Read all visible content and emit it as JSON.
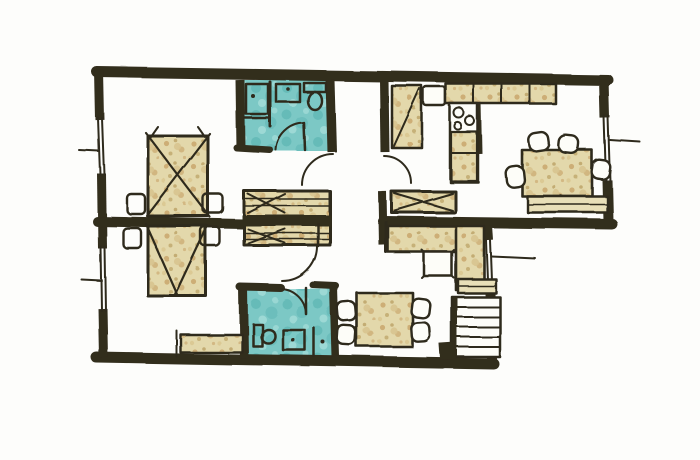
{
  "diagram": {
    "kind": "hand-drawn watercolor apartment floor plan",
    "text_content": "",
    "rooms": [
      {
        "name": "bedroom-top-left"
      },
      {
        "name": "bedroom-bottom-left"
      },
      {
        "name": "bathroom-top"
      },
      {
        "name": "bathroom-bottom"
      },
      {
        "name": "hallway-center"
      },
      {
        "name": "kitchen"
      },
      {
        "name": "dining-room-right"
      },
      {
        "name": "living-area-bottom"
      },
      {
        "name": "stair-landing"
      }
    ],
    "furniture": [
      {
        "name": "double-bed-top",
        "room": "bedroom-top-left"
      },
      {
        "name": "nightstand",
        "count": 2,
        "room": "bedroom-top-left"
      },
      {
        "name": "double-bed-bottom",
        "room": "bedroom-bottom-left"
      },
      {
        "name": "nightstand",
        "count": 2,
        "room": "bedroom-bottom-left"
      },
      {
        "name": "bench-dresser",
        "room": "bedroom-bottom-left"
      },
      {
        "name": "shower",
        "room": "bathroom-top"
      },
      {
        "name": "sink",
        "room": "bathroom-top"
      },
      {
        "name": "toilet",
        "room": "bathroom-top"
      },
      {
        "name": "toilet",
        "room": "bathroom-bottom"
      },
      {
        "name": "sink",
        "room": "bathroom-bottom"
      },
      {
        "name": "shower-corner",
        "room": "bathroom-bottom"
      },
      {
        "name": "double-wardrobe-with-x-marks",
        "room": "hallway-center"
      },
      {
        "name": "hall-wardrobe-with-x-marks",
        "room": "hallway-center"
      },
      {
        "name": "pantry-cabinet-with-diagonal-door",
        "room": "kitchen"
      },
      {
        "name": "fridge",
        "room": "kitchen"
      },
      {
        "name": "counter-run",
        "room": "kitchen"
      },
      {
        "name": "sink-stove-corner-unit",
        "room": "kitchen"
      },
      {
        "name": "dining-table",
        "chairs": 4,
        "room": "dining-room-right"
      },
      {
        "name": "sideboard-band",
        "room": "dining-room-right"
      },
      {
        "name": "l-shaped-sofa",
        "room": "living-area-bottom"
      },
      {
        "name": "coffee-table",
        "room": "living-area-bottom"
      },
      {
        "name": "square-table",
        "chairs": 4,
        "room": "living-area-bottom"
      },
      {
        "name": "low-cabinet",
        "room": "living-area-bottom"
      },
      {
        "name": "staircase",
        "treads": 5,
        "room": "stair-landing"
      }
    ],
    "openings": {
      "windows": [
        "left-wall-upper",
        "left-wall-lower",
        "right-wall-dining",
        "right-wall-living"
      ],
      "door_arcs": [
        "bathroom-top-door",
        "hall-to-bedroom-door",
        "hall-to-kitchen-door",
        "hall-lower-door",
        "bathroom-bottom-door"
      ]
    }
  },
  "palette": {
    "paper": "#fdfdfb",
    "wall": "#332d1e",
    "ink": "#2e2a1c",
    "bathroom": "#7cc8c5",
    "bathroom_shade": "#5fb6b4",
    "bathroom_light": "#a5ddd9",
    "furniture": "#e3d8ab",
    "furniture_shade": "#c8a469",
    "furniture_dark": "#a98945",
    "band": "#e8dfb8",
    "white": "#fdfdf8"
  }
}
